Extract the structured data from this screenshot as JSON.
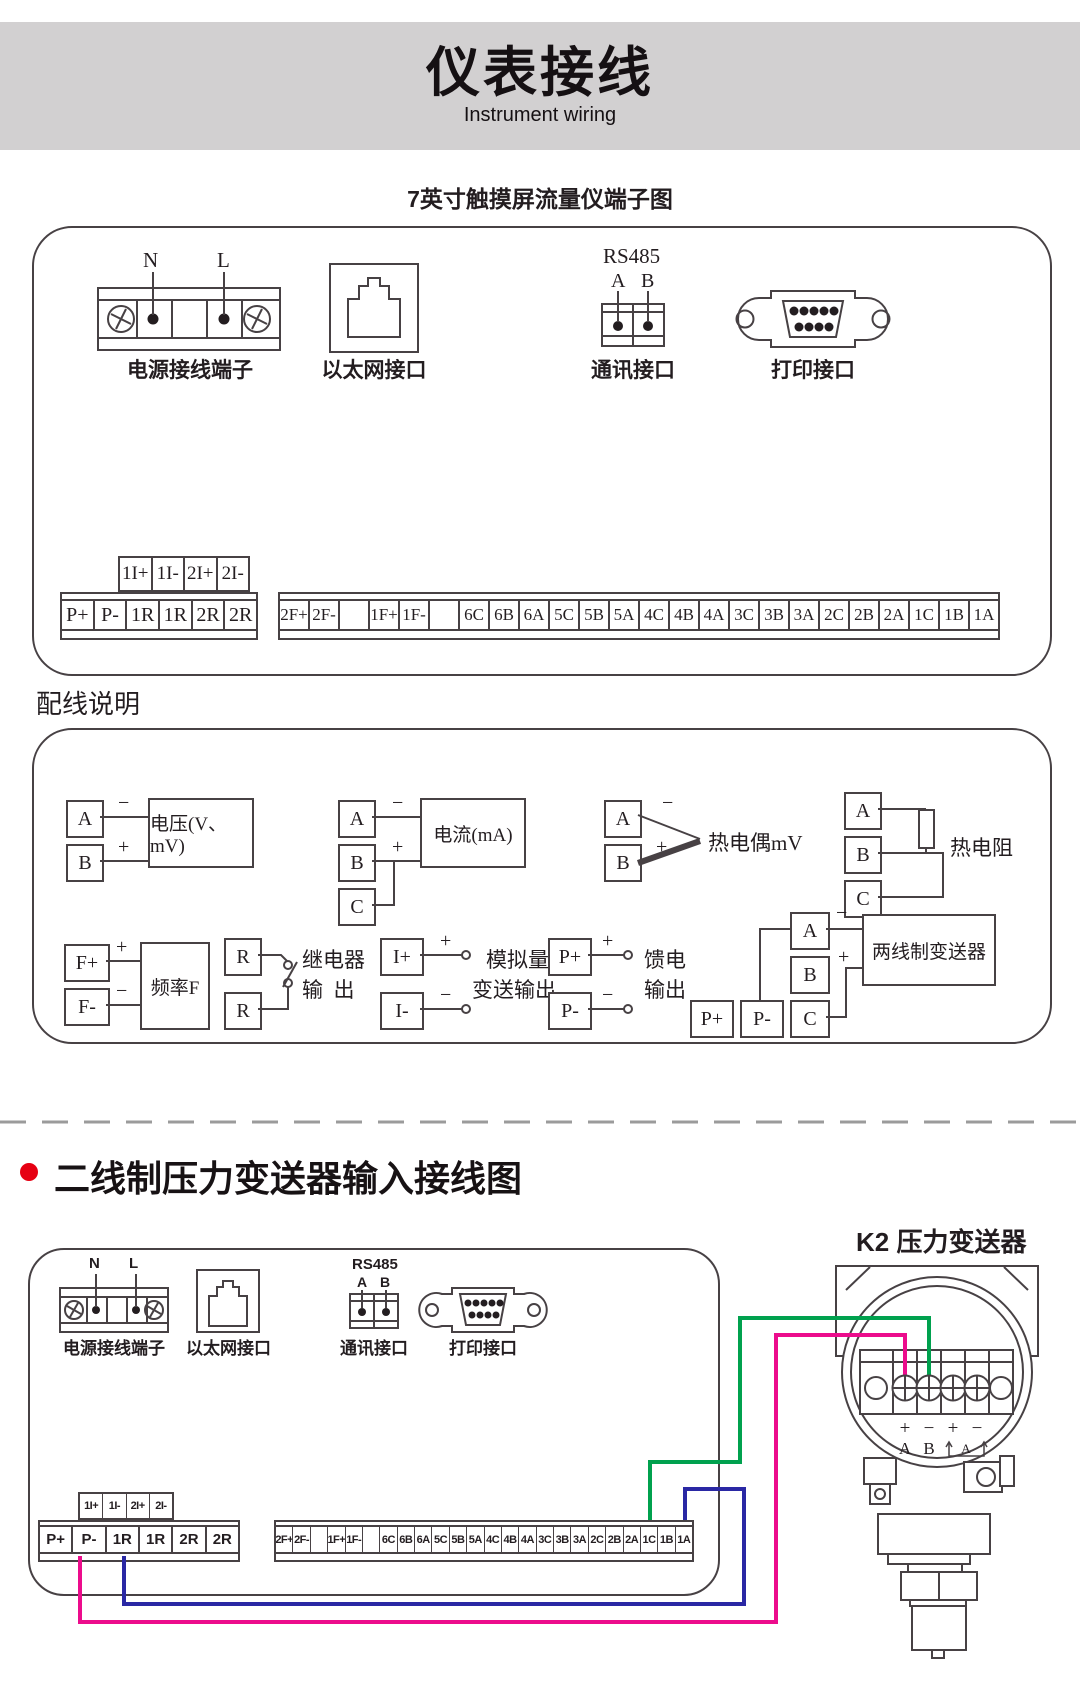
{
  "banner": {
    "title": "仪表接线",
    "subtitle": "Instrument wiring",
    "bg": "#d2d0d1"
  },
  "diagram1": {
    "heading": "7英寸触摸屏流量仪端子图",
    "power": {
      "label": "电源接线端子",
      "pin_n": "N",
      "pin_l": "L"
    },
    "ethernet": {
      "label": "以太网接口"
    },
    "comm": {
      "label": "通讯接口",
      "protocol": "RS485",
      "pin_a": "A",
      "pin_b": "B"
    },
    "printer": {
      "label": "打印接口"
    },
    "strip_small": [
      "1I+",
      "1I-",
      "2I+",
      "2I-"
    ],
    "strip_left": [
      "P+",
      "P-",
      "1R",
      "1R",
      "2R",
      "2R"
    ],
    "strip_right": [
      "2F+",
      "2F-",
      "",
      "1F+",
      "1F-",
      "",
      "6C",
      "6B",
      "6A",
      "5C",
      "5B",
      "5A",
      "4C",
      "4B",
      "4A",
      "3C",
      "3B",
      "3A",
      "2C",
      "2B",
      "2A",
      "1C",
      "1B",
      "1A"
    ]
  },
  "wiring": {
    "heading": "配线说明",
    "signs": {
      "plus": "+",
      "minus": "−"
    },
    "voltage": {
      "a": "A",
      "b": "B",
      "label": "电压(V、mV)"
    },
    "current": {
      "a": "A",
      "b": "B",
      "c": "C",
      "label": "电流(mA)"
    },
    "thermocouple": {
      "a": "A",
      "b": "B",
      "label": "热电偶mV"
    },
    "rtd": {
      "a": "A",
      "b": "B",
      "c": "C",
      "label": "热电阻"
    },
    "frequency": {
      "fp": "F+",
      "fm": "F-",
      "label": "频率F"
    },
    "relay": {
      "r1": "R",
      "r2": "R",
      "label1": "继电器",
      "label2": "输  出"
    },
    "analog": {
      "ip": "I+",
      "im": "I-",
      "label1": "模拟量",
      "label2": "变送输出"
    },
    "feed": {
      "pp": "P+",
      "pm": "P-",
      "label1": "馈电",
      "label2": "输出"
    },
    "twowire": {
      "a": "A",
      "b": "B",
      "c": "C",
      "pp": "P+",
      "pm": "P-",
      "label": "两线制变送器"
    }
  },
  "diagram2": {
    "bullet_color": "#e60012",
    "heading": "二线制压力变送器输入接线图",
    "k2_title": "K2 压力变送器",
    "power": {
      "label": "电源接线端子",
      "pin_n": "N",
      "pin_l": "L"
    },
    "ethernet": {
      "label": "以太网接口"
    },
    "comm": {
      "label": "通讯接口",
      "protocol": "RS485",
      "pin_a": "A",
      "pin_b": "B"
    },
    "printer": {
      "label": "打印接口"
    },
    "strip_small": [
      "1I+",
      "1I-",
      "2I+",
      "2I-"
    ],
    "strip_left": [
      "P+",
      "P-",
      "1R",
      "1R",
      "2R",
      "2R"
    ],
    "strip_right": [
      "2F+",
      "2F-",
      "",
      "1F+",
      "1F-",
      "",
      "6C",
      "6B",
      "6A",
      "5C",
      "5B",
      "5A",
      "4C",
      "4B",
      "4A",
      "3C",
      "3B",
      "3A",
      "2C",
      "2B",
      "2A",
      "1C",
      "1B",
      "1A"
    ],
    "transmitter": {
      "sign1": "+",
      "sign2": "−",
      "sign3": "+",
      "sign4": "−",
      "pin1": "A",
      "pin2": "B",
      "pin3": "A"
    },
    "wire_colors": {
      "pink": "#ec0c8c",
      "blue": "#2a28a4",
      "green": "#00a14e"
    }
  }
}
